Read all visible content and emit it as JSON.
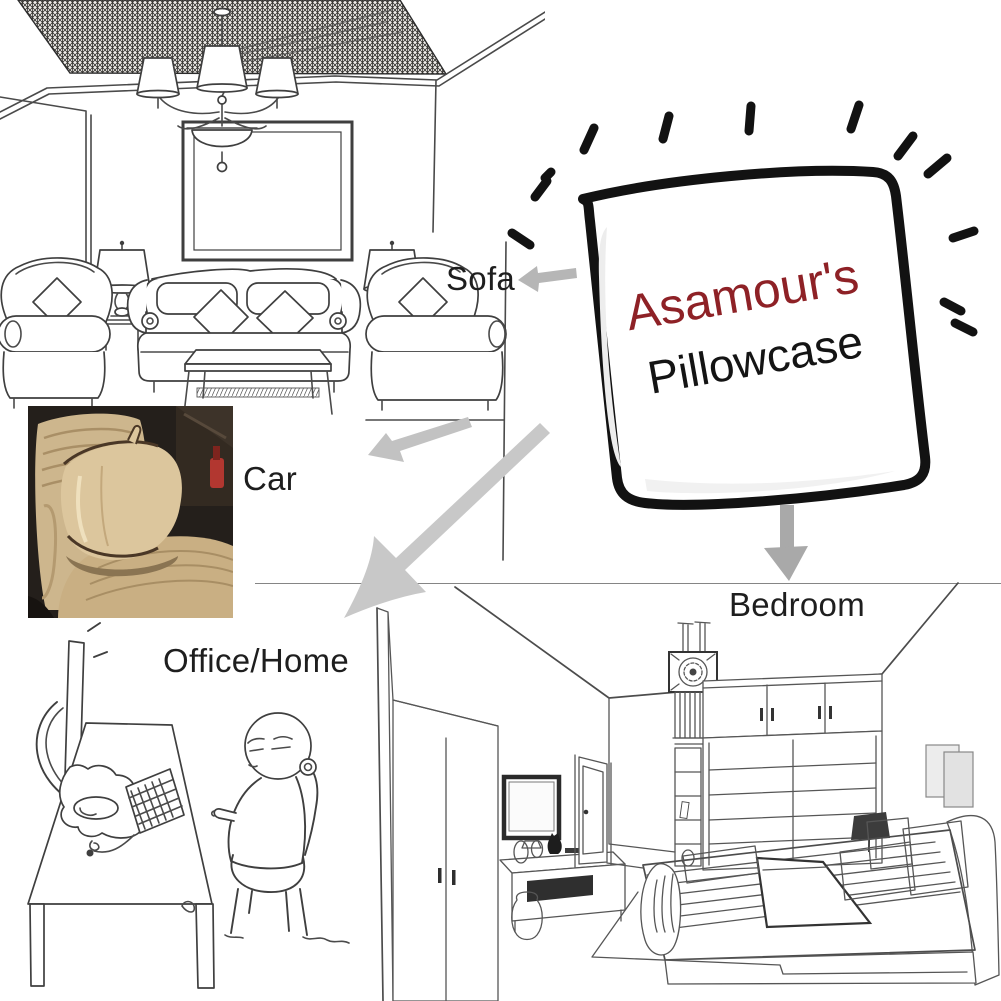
{
  "product": {
    "brand": "Asamour's",
    "name": "Pillowcase"
  },
  "labels": {
    "sofa": "Sofa",
    "car": "Car",
    "office_home": "Office/Home",
    "bedroom": "Bedroom"
  },
  "colors": {
    "background": "#ffffff",
    "brand_red": "#8e2126",
    "product_name_black": "#141414",
    "label_text": "#1e1e1e",
    "sketch_ink": "#4a4a4a",
    "pillow_outline": "#121212",
    "arrow_sofa_gray": "#b6b6b6",
    "arrow_car_gray": "#c2c2c2",
    "arrow_office_gray": "#c8c8c8",
    "arrow_bedroom_gray": "#a9a9a9",
    "photo_pillow_beige": "#dcc69d",
    "photo_seat_tan": "#cdb68d",
    "photo_piping_brown": "#4a3726",
    "photo_interior_dark": "#241f1b",
    "photo_buckle_red": "#b23730"
  }
}
